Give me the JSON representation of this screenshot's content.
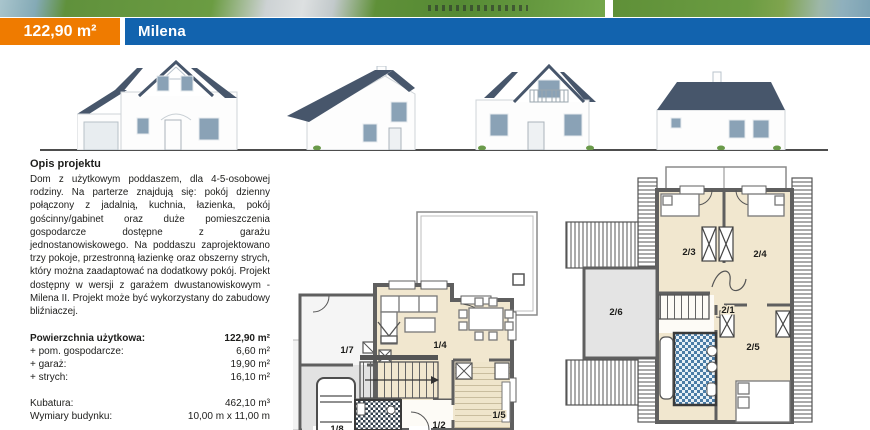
{
  "header": {
    "area": "122,90 m²",
    "name": "Milena"
  },
  "colors": {
    "accent_orange": "#ef7b00",
    "accent_blue": "#1263ae",
    "roof_slate": "#47566b",
    "plan_room_cream": "#f1e7cf",
    "plan_gray": "#e4e4e4",
    "bathroom_tile_blue": "#4b7ca6",
    "wall_gray": "#5f5f5f"
  },
  "description": {
    "heading": "Opis projektu",
    "body": "Dom z użytkowym poddaszem, dla 4-5-osobowej rodziny. Na parterze znajdują się: pokój dzienny połączony z jadalnią, kuchnia, łazienka, pokój gościnny/gabinet oraz duże pomieszczenia gospodarcze dostępne z garażu jednostanowiskowego. Na poddaszu zaprojektowano trzy pokoje, przestronną łazienkę oraz obszerny strych, który można zaadaptować na dodatkowy pokój. Projekt dostępny w wersji z garażem dwustanowiskowym - Milena II. Projekt może być wykorzystany do zabudowy bliźniaczej."
  },
  "specs": {
    "rows": [
      {
        "label": "Powierzchnia użytkowa:",
        "value": "122,90 m²"
      },
      {
        "label": "+ pom. gospodarcze:",
        "value": "6,60 m²"
      },
      {
        "label": "+ garaż:",
        "value": "19,90 m²"
      },
      {
        "label": "+ strych:",
        "value": "16,10 m²"
      },
      {
        "label": "Kubatura:",
        "value": "462,10 m³"
      },
      {
        "label": "Wymiary budynku:",
        "value": "10,00 m x 11,00 m"
      }
    ]
  },
  "plans": {
    "ground_floor": {
      "labels": {
        "living": "1/4",
        "utility": "1/7",
        "kitchen": "1/5",
        "hall": "1/2",
        "garage": "1/8"
      }
    },
    "attic": {
      "labels": {
        "bedroom_left": "2/3",
        "bedroom_right": "2/4",
        "hall": "2/1",
        "bedroom_bottom": "2/5",
        "storage": "2/6"
      }
    }
  }
}
